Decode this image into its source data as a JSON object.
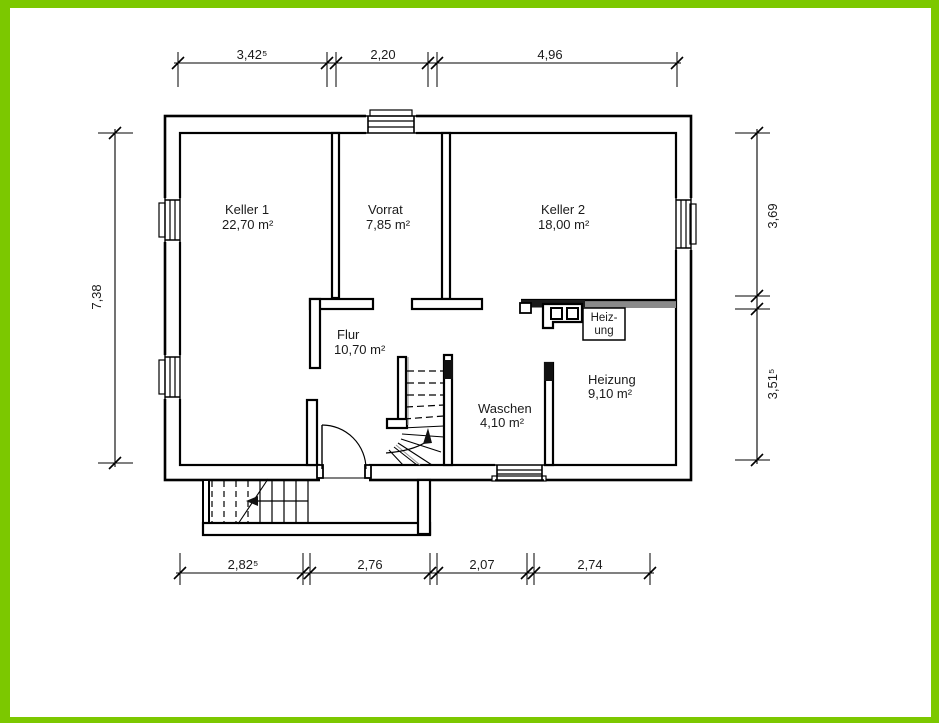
{
  "plan": {
    "rooms": [
      {
        "name": "Keller 1",
        "area": "22,70 m²"
      },
      {
        "name": "Vorrat",
        "area": "7,85 m²"
      },
      {
        "name": "Keller 2",
        "area": "18,00 m²"
      },
      {
        "name": "Flur",
        "area": "10,70 m²"
      },
      {
        "name": "Waschen",
        "area": "4,10 m²"
      },
      {
        "name": "Heizung",
        "area": "9,10 m²"
      }
    ],
    "heater_box": {
      "line1": "Heiz-",
      "line2": "ung"
    },
    "dimensions": {
      "top": [
        "3,42⁵",
        "2,20",
        "4,96"
      ],
      "bottom": [
        "2,82⁵",
        "2,76",
        "2,07",
        "2,74"
      ],
      "left": [
        "7,38"
      ],
      "right": [
        "3,69",
        "3,51⁵"
      ]
    },
    "colors": {
      "border": "#7CC800",
      "walls": "#000000",
      "gray_wall": "#8A8A8A",
      "background": "#FFFFFF"
    }
  }
}
